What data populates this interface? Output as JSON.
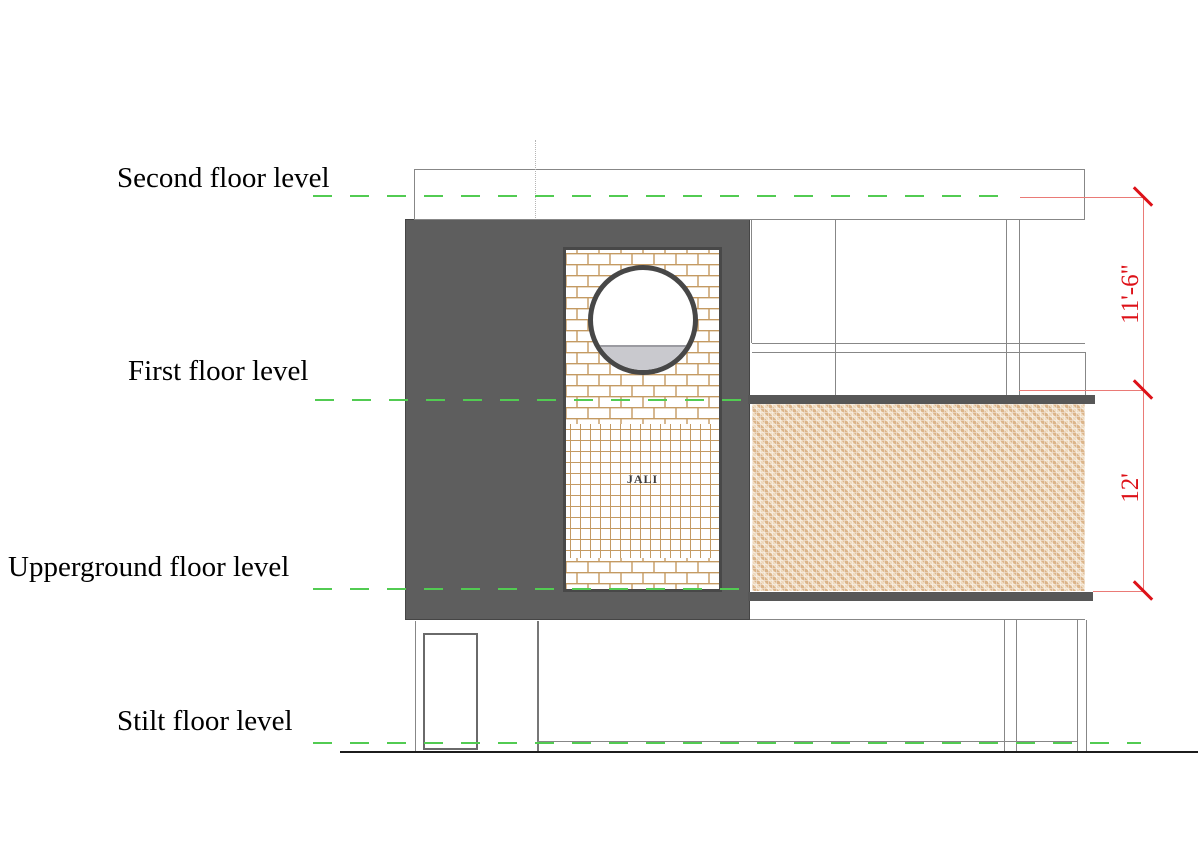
{
  "levels": [
    {
      "label": "Second floor level"
    },
    {
      "label": "First floor level"
    },
    {
      "label": "Upperground floor level"
    },
    {
      "label": "Stilt floor level"
    }
  ],
  "dimensions": [
    {
      "text": "11'-6\"",
      "from": "Second floor level",
      "to": "First floor level"
    },
    {
      "text": "12'",
      "from": "First floor level",
      "to": "Upperground floor level"
    }
  ],
  "panel": {
    "label": "JALI"
  },
  "colors": {
    "level_line_green": "#52cb52",
    "dimension_red": "#dd1118",
    "wall_gray": "#5e5e5e",
    "brick_mortar_tan": "#c49a62",
    "screen_weave_tan": "#dbb489",
    "window_fill_gray": "#c9c9ce"
  }
}
